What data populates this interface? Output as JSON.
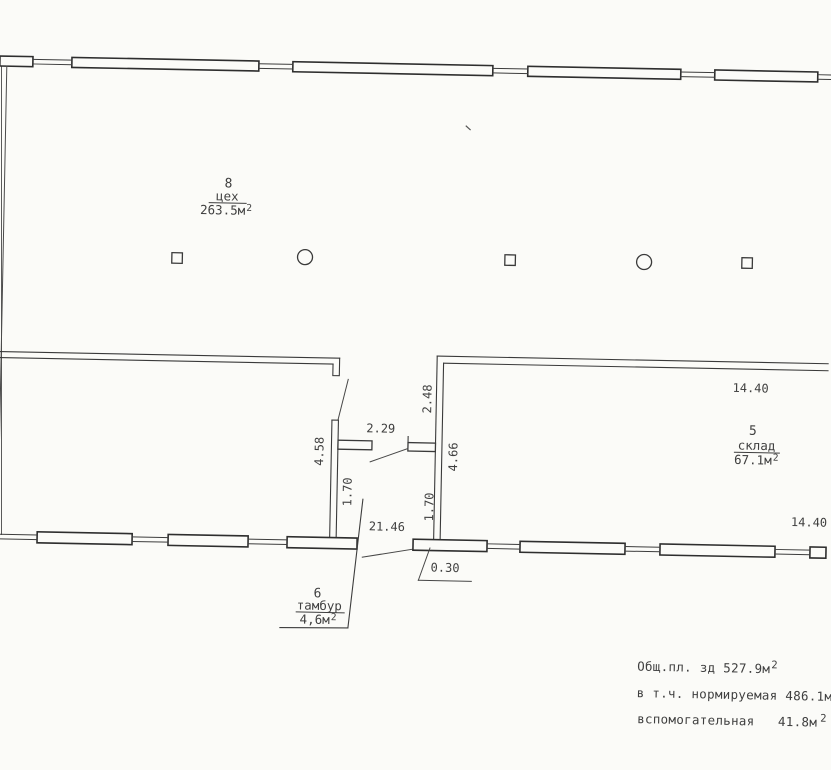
{
  "drawing": {
    "rooms": {
      "workshop": {
        "number": "8",
        "name": "цех",
        "area": "263.5м",
        "area_sup": "2"
      },
      "storage": {
        "number": "5",
        "name": "склад",
        "area": "67.1м",
        "area_sup": "2"
      },
      "vestibule": {
        "number": "6",
        "name": "тамбур",
        "area": "4,6м",
        "area_sup": "2"
      }
    },
    "dimensions": {
      "d229": "2.29",
      "d248": "2.48",
      "d458": "4.58",
      "d466": "4.66",
      "d170a": "1.70",
      "d170b": "1.70",
      "d2146": "21.46",
      "d030": "0.30",
      "d1440_top": "14.40",
      "d1440_bottom": "14.40"
    },
    "summary": {
      "line1": {
        "text": "Общ.пл. зд 527.9м",
        "sup": "2"
      },
      "line2": {
        "text": "в т.ч. нормируемая 486.1м",
        "sup": "2"
      },
      "line3": {
        "text": "вспомогательная   41.8м",
        "sup": "2"
      }
    },
    "colors": {
      "ink": "#3b3b3b",
      "paper": "#fbfbf8"
    }
  }
}
